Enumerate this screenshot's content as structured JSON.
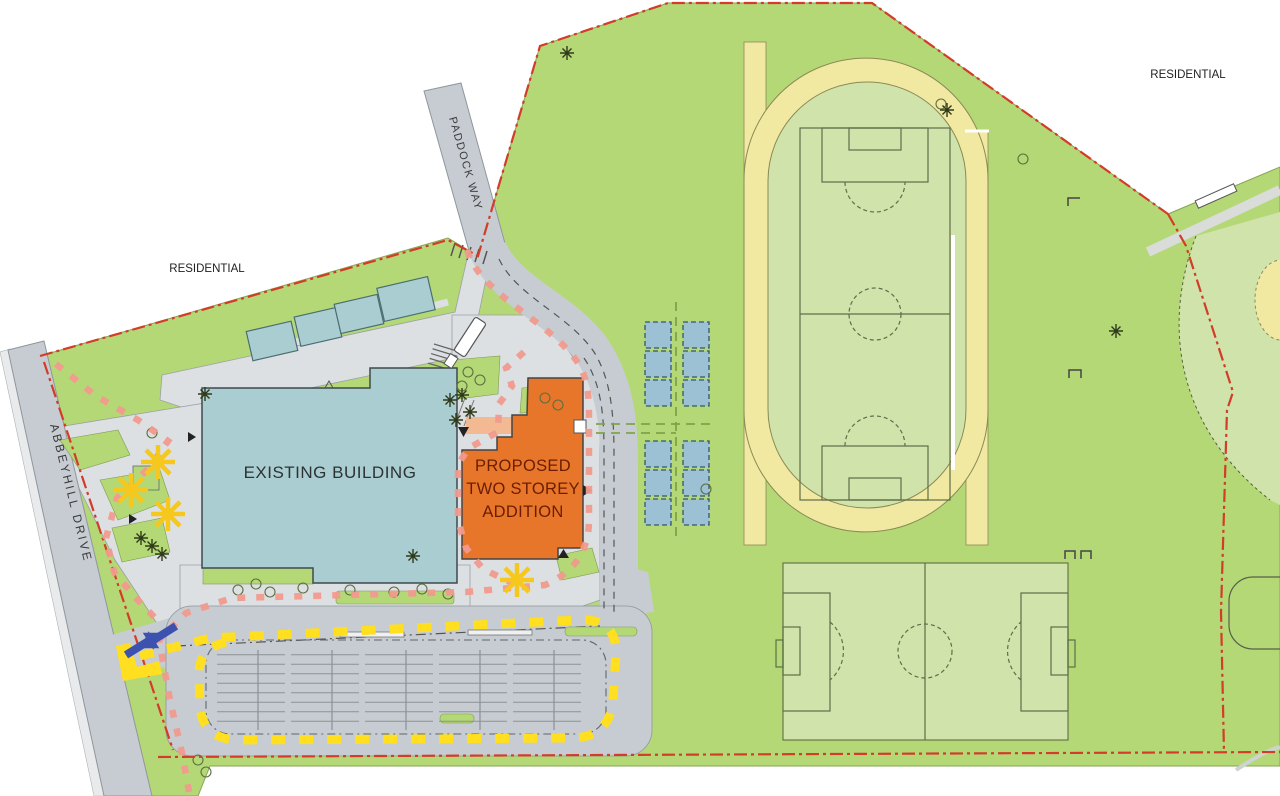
{
  "labels": {
    "residential_nw": "RESIDENTIAL",
    "residential_ne": "RESIDENTIAL",
    "paddock_way": "PADDOCK WAY",
    "abbeyhill_drive": "ABBEYHILL DRIVE",
    "existing_building": "EXISTING BUILDING",
    "proposed_addition": [
      "PROPOSED",
      "TWO STOREY",
      "ADDITION"
    ]
  },
  "colors": {
    "site_green": "#b5d877",
    "field_green": "#cfe3ab",
    "track_yellow": "#f1e9a1",
    "building_teal": "#a9cdd0",
    "addition_orange": "#e8762a",
    "addition_text": "#6b1d02",
    "road_gray": "#c6ccd1",
    "plaza_gray": "#dce0e2",
    "route_pink": "#f29a8e",
    "route_yellow": "#ffdf1f",
    "boundary_red": "#d23c28",
    "arrow_blue": "#3d52ae",
    "portable_blue": "#9cc0d4",
    "canopy_peach": "#f2b992",
    "star_yellow": "#f6c71c"
  }
}
